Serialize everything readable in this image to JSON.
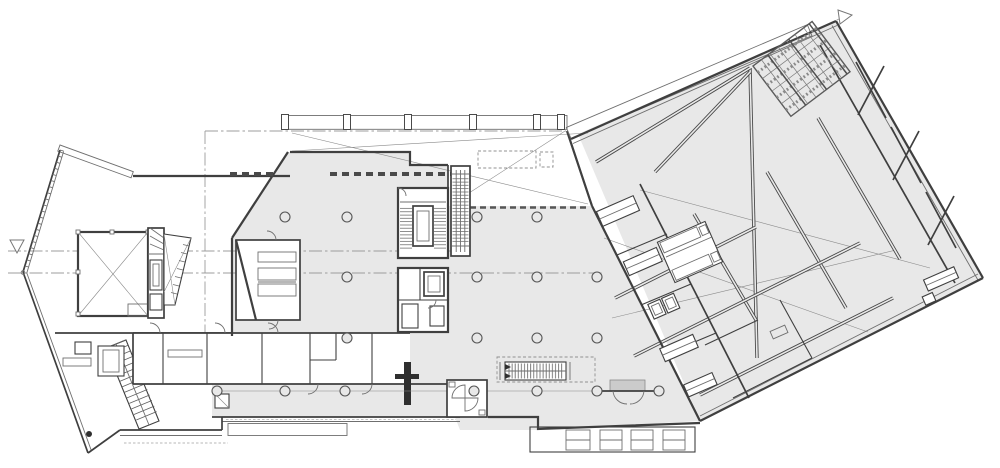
{
  "meta": {
    "title": "Ground floor plan",
    "description": "Black-and-white architectural CAD floor plan: an angled west wing with a square double-height room, stairs and service rooms; a large light-grey central hall on a round-column grid with escalators, cores and entrances; and a triangular east wing rotated off-grid with diagonal structural walls, a louvered facade strip and a hatched roof-canopy grid at the upper right. Section markers (small triangles) with dash-dot section lines appear at the left edge and top right.",
    "drawing_type": "architectural floor plan",
    "visible_text": "none"
  },
  "colors": {
    "background": "#ffffff",
    "floor_fill": "#e8e8e8",
    "wing_floor_fill": "#e9e9e9",
    "wall_line": "#3f3f3f",
    "medium_line": "#5a5a5a",
    "thin_line": "#8a8a8a",
    "dash_dot_line": "#9c9c9c",
    "hatch_line": "#6a6a6a",
    "dark_accent": "#2f2f2f",
    "entrance_mat_fill": "#cbcbcb"
  },
  "markers": {
    "left_section_marker": "triangle",
    "top_right_section_marker": "triangle"
  },
  "structure": {
    "columns": [
      [
        285,
        217
      ],
      [
        347,
        217
      ],
      [
        477,
        217
      ],
      [
        537,
        217
      ],
      [
        347,
        277
      ],
      [
        477,
        277
      ],
      [
        537,
        277
      ],
      [
        597,
        277
      ],
      [
        347,
        338
      ],
      [
        477,
        338
      ],
      [
        537,
        338
      ],
      [
        597,
        338
      ],
      [
        217,
        391
      ],
      [
        285,
        391
      ],
      [
        345,
        391
      ],
      [
        474,
        391
      ],
      [
        537,
        391
      ],
      [
        597,
        391
      ],
      [
        659,
        391
      ]
    ],
    "column_radius": 5,
    "facade_posts_x": [
      285,
      347,
      408,
      473,
      537,
      561
    ],
    "facade_posts_y": 114.5,
    "escalator_banks": 2,
    "stair_runs": 9,
    "revolving_door_count": 1
  }
}
